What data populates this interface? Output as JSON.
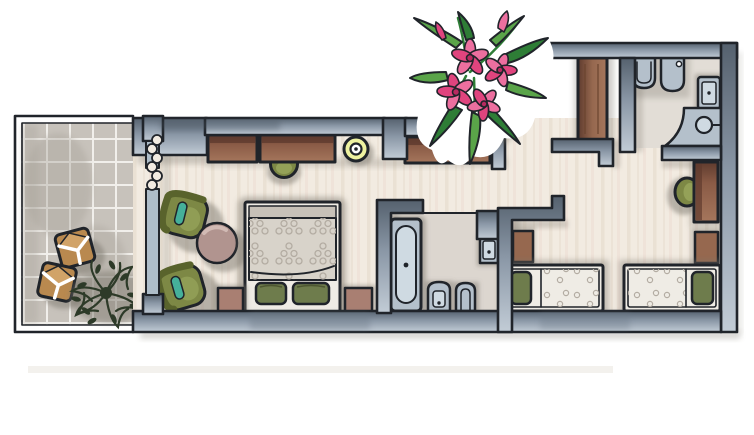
{
  "title": "Hand-painted apartment floor plan illustration",
  "colors": {
    "outline": "#20242a",
    "wall-dark": "#55616e",
    "wall-mid": "#8a97a6",
    "wall-light": "#c2ccd6",
    "panel": "#aebdc9",
    "floor": "#f2ebe1",
    "floor-streak": "#e4d8c9",
    "bath-floor": "#dcd6cf",
    "wc-floor": "#e2ddd6",
    "tile": "#c7c2bb",
    "tile-dark": "#a8a39a",
    "grout": "#f1efeb",
    "wood": "#8a5b46",
    "wood-dark": "#5f3b2e",
    "wood-light": "#a5765c",
    "wardrobe": "#96684f",
    "chair-green": "#7d8845",
    "chair-green-light": "#98a65c",
    "chair-green-dark": "#59632c",
    "teal": "#45b09a",
    "pillow-green": "#6e7c4c",
    "nightstand": "#a97f72",
    "table-pink": "#b1948f",
    "stool-yellow": "#eef2a0",
    "fixture": "#b4c0cb",
    "fixture-light": "#cfdae2",
    "sheet": "#efece5",
    "duvet": "#d8d3ca",
    "duvet-head": "#c7c1b8",
    "pattern-dot": "#b3aca2",
    "plant": "#2d3a28",
    "flower-pink": "#ec6f9f",
    "flower-mid": "#e0447e",
    "flower-dark": "#b82a60",
    "leaf": "#5aa449",
    "leaf-dark": "#2e7d36",
    "cube": "#b9894f",
    "cube-light": "#d1a368",
    "shadow": "rgba(125,120,110,0.5)",
    "band": "#f3f1ed"
  },
  "floorplan": {
    "rooms": [
      {
        "id": "balcony",
        "label": "balcony with tiled floor",
        "items": [
          "cube stool",
          "cube stool",
          "potted plant"
        ]
      },
      {
        "id": "living-room",
        "label": "living room with double bed",
        "items": [
          "sideboard",
          "sideboard",
          "wall desk",
          "desk chair",
          "round yellow stool",
          "armchair",
          "armchair",
          "round side table",
          "double bed",
          "green pillows",
          "nightstand",
          "nightstand",
          "curtain at balcony door"
        ]
      },
      {
        "id": "bathroom",
        "label": "bathroom",
        "items": [
          "bathtub",
          "washbasin",
          "toilet",
          "bidet"
        ]
      },
      {
        "id": "wc",
        "label": "toilet room",
        "items": [
          "wall-hung toilet",
          "bidet",
          "washbasin",
          "corner vanity with round basin"
        ]
      },
      {
        "id": "hallway",
        "label": "entry hall",
        "items": [
          "wardrobe"
        ]
      },
      {
        "id": "twin-bedroom",
        "label": "twin bedroom",
        "items": [
          "single bed",
          "single bed",
          "nightstand",
          "nightstand",
          "desk",
          "desk chair"
        ]
      }
    ],
    "decoration": {
      "id": "oleander",
      "label": "pink oleander branch"
    }
  }
}
